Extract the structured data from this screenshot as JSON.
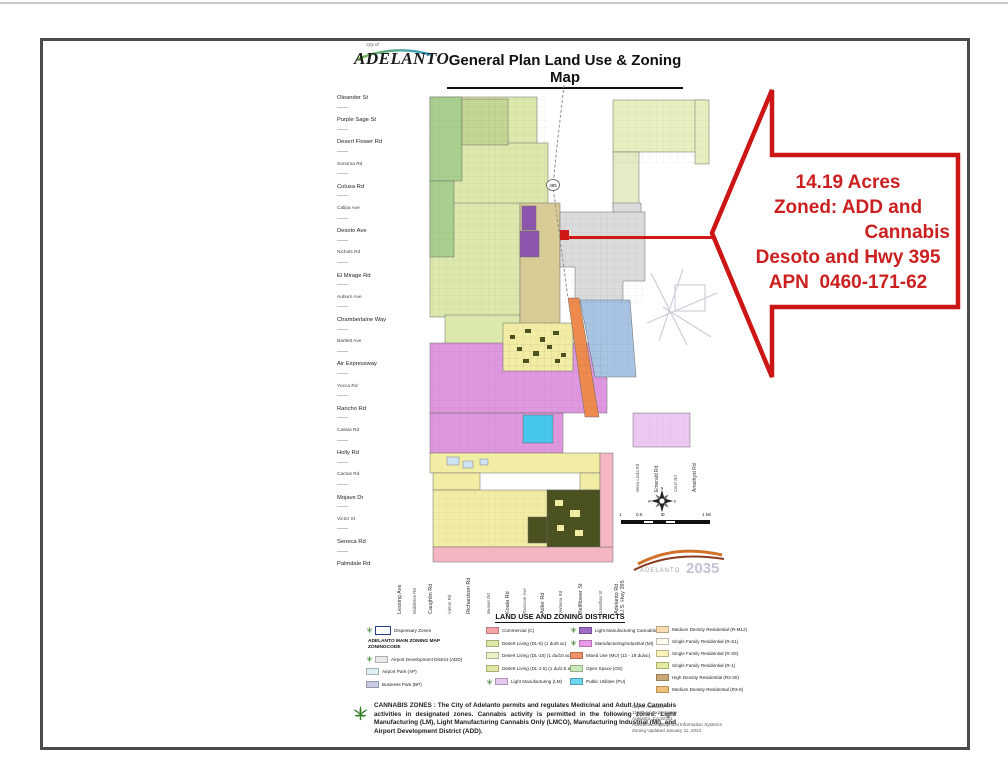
{
  "header": {
    "logo_small": "City of",
    "logo_text": "ADELANTO",
    "title": "General Plan Land Use & Zoning Map"
  },
  "callout": {
    "line1": "14.19 Acres",
    "line2": "Zoned: ADD and",
    "line3": "Cannabis",
    "line4": "Desoto and Hwy 395",
    "line5": "APN  0460-171-62",
    "accent_color": "#cc2020"
  },
  "map": {
    "shield": "395",
    "compass": {
      "n": "N",
      "e": "E",
      "s": "S",
      "w": "W"
    },
    "scale_labels": [
      "1",
      "0.5",
      "0",
      "1 Mi"
    ],
    "plan_logo": {
      "name": "ADELANTO",
      "year": "2035"
    },
    "left_streets": [
      {
        "label": "Oleander St",
        "size": "lg"
      },
      {
        "label": "Purple Sage St",
        "size": "lg"
      },
      {
        "label": "Desert Flower Rd",
        "size": "lg"
      },
      {
        "label": "Sonoma Rd",
        "size": "sm"
      },
      {
        "label": "Colusa Rd",
        "size": "lg"
      },
      {
        "label": "Calipa Ave",
        "size": "sm"
      },
      {
        "label": "Desoto Ave",
        "size": "lg"
      },
      {
        "label": "Nichols Rd",
        "size": "sm"
      },
      {
        "label": "El Mirage Rd",
        "size": "lg"
      },
      {
        "label": "Auburn Ave",
        "size": "sm"
      },
      {
        "label": "Chamberlaine Way",
        "size": "lg"
      },
      {
        "label": "Bartlett Ave",
        "size": "sm"
      },
      {
        "label": "Air Expressway",
        "size": "lg"
      },
      {
        "label": "Yucca Rd",
        "size": "sm"
      },
      {
        "label": "Rancho Rd",
        "size": "lg"
      },
      {
        "label": "Cassia Rd",
        "size": "sm"
      },
      {
        "label": "Holly Rd",
        "size": "lg"
      },
      {
        "label": "Cactus Rd",
        "size": "sm"
      },
      {
        "label": "Mojave Dr",
        "size": "lg"
      },
      {
        "label": "Victor St",
        "size": "sm"
      },
      {
        "label": "Seneca Rd",
        "size": "lg"
      },
      {
        "label": "Palmdale Rd",
        "size": "lg"
      }
    ],
    "bottom_streets": [
      {
        "label": "Lessing Ave",
        "size": "lg"
      },
      {
        "label": "Middleton Rd",
        "size": "sm"
      },
      {
        "label": "Caughlin Rd",
        "size": "lg"
      },
      {
        "label": "Vinton Rd",
        "size": "sm"
      },
      {
        "label": "Richardson Rd",
        "size": "lg"
      },
      {
        "label": "Beaver Rd",
        "size": "sm"
      },
      {
        "label": "Koala Rd",
        "size": "lg"
      },
      {
        "label": "Raccoon Ave",
        "size": "sm"
      },
      {
        "label": "Adler Rd",
        "size": "lg"
      },
      {
        "label": "Verbena Rd",
        "size": "sm"
      },
      {
        "label": "Bellflower St",
        "size": "lg"
      },
      {
        "label": "Jonathan St",
        "size": "sm"
      },
      {
        "label": "Adelanto Rd",
        "label2": "U.S. Hwy 395",
        "size": "lg"
      }
    ],
    "right_streets": [
      {
        "label": "Mesa Linda Rd",
        "size": "sm"
      },
      {
        "label": "Emerald Rd",
        "size": "lg"
      },
      {
        "label": "Court Rd",
        "size": "sm"
      },
      {
        "label": "Amethyst Rd",
        "size": "lg"
      }
    ]
  },
  "legend": {
    "title": "LAND USE AND ZONING DISTRICTS",
    "columns": [
      [
        {
          "kind": "dispensary",
          "label": "Dispensary Zones",
          "color": "#ffffff",
          "leaf": true
        },
        {
          "kind": "header",
          "line1": "ADELANTO MAIN ZONING MAP",
          "line2": "ZONINGCODE"
        },
        {
          "label": "Airport Development District (ADD)",
          "color": "#e9e9e9",
          "leaf": true
        },
        {
          "label": "Airport Park (AP)",
          "color": "#ddeef5"
        },
        {
          "label": "Business Park (BP)",
          "color": "#c7cbe3"
        }
      ],
      [
        {
          "label": "Commercial (C)",
          "color": "#f4a6a6"
        },
        {
          "label": "Desert Living (DL-5) (1 du/5 ac)",
          "color": "#dce9a4"
        },
        {
          "label": "Desert Living (DL-10) (1 du/10 ac)",
          "color": "#e9f2c6"
        },
        {
          "label": "Desert Living (DL-2.5) (1 du/2.5 ac)",
          "color": "#e3e6a2"
        },
        {
          "label": "Light Manufacturing (LM)",
          "color": "#e6c8f1",
          "leaf": true
        }
      ],
      [
        {
          "label": "Light Manufacturing Cannabis Only",
          "color": "#a06cc5",
          "leaf": true
        },
        {
          "label": "Manufacturing/Industrial (MI)",
          "color": "#ea9ae8",
          "leaf": true
        },
        {
          "label": "Mixed Use (MU) (12 - 18 du/ac)",
          "color": "#f0916a"
        },
        {
          "label": "Open Space (OS)",
          "color": "#c8e8b6"
        },
        {
          "label": "Public Utilities (PU)",
          "color": "#6cd6f2"
        }
      ],
      [
        {
          "label": "Medium Density Residential (R-M12)",
          "color": "#f8ddb2"
        },
        {
          "label": "Single Family Residential (R-S1)",
          "color": "#fdfaef"
        },
        {
          "label": "Single Family Residential (R-S5)",
          "color": "#faf3bb"
        },
        {
          "label": "Single Family Residential (R-1)",
          "color": "#e5ec9e"
        },
        {
          "label": "High Density Residential (R3-30)",
          "color": "#c9a97a"
        },
        {
          "label": "Medium Density Residential (R3-8)",
          "color": "#f1c179"
        }
      ]
    ]
  },
  "cannabis_note": "CANNABIS ZONES : The City of Adelanto permits and regulates Medicinal and Adult Use Cannabis activities in designated zones. Cannabis activity is permitted in the following zones: Light Manufacturing (LM), Light Manufacturing Cannabis Only (LMCO), Manufacturing Industrial (MI), and Airport Development District (ADD).",
  "credits": [
    "City of Adelanto",
    "11600 Air Expressway",
    "Adelanto, CA 92301",
    "Adelanto Geographical Information Systems",
    "Zoning Updated January 11, 2024"
  ]
}
